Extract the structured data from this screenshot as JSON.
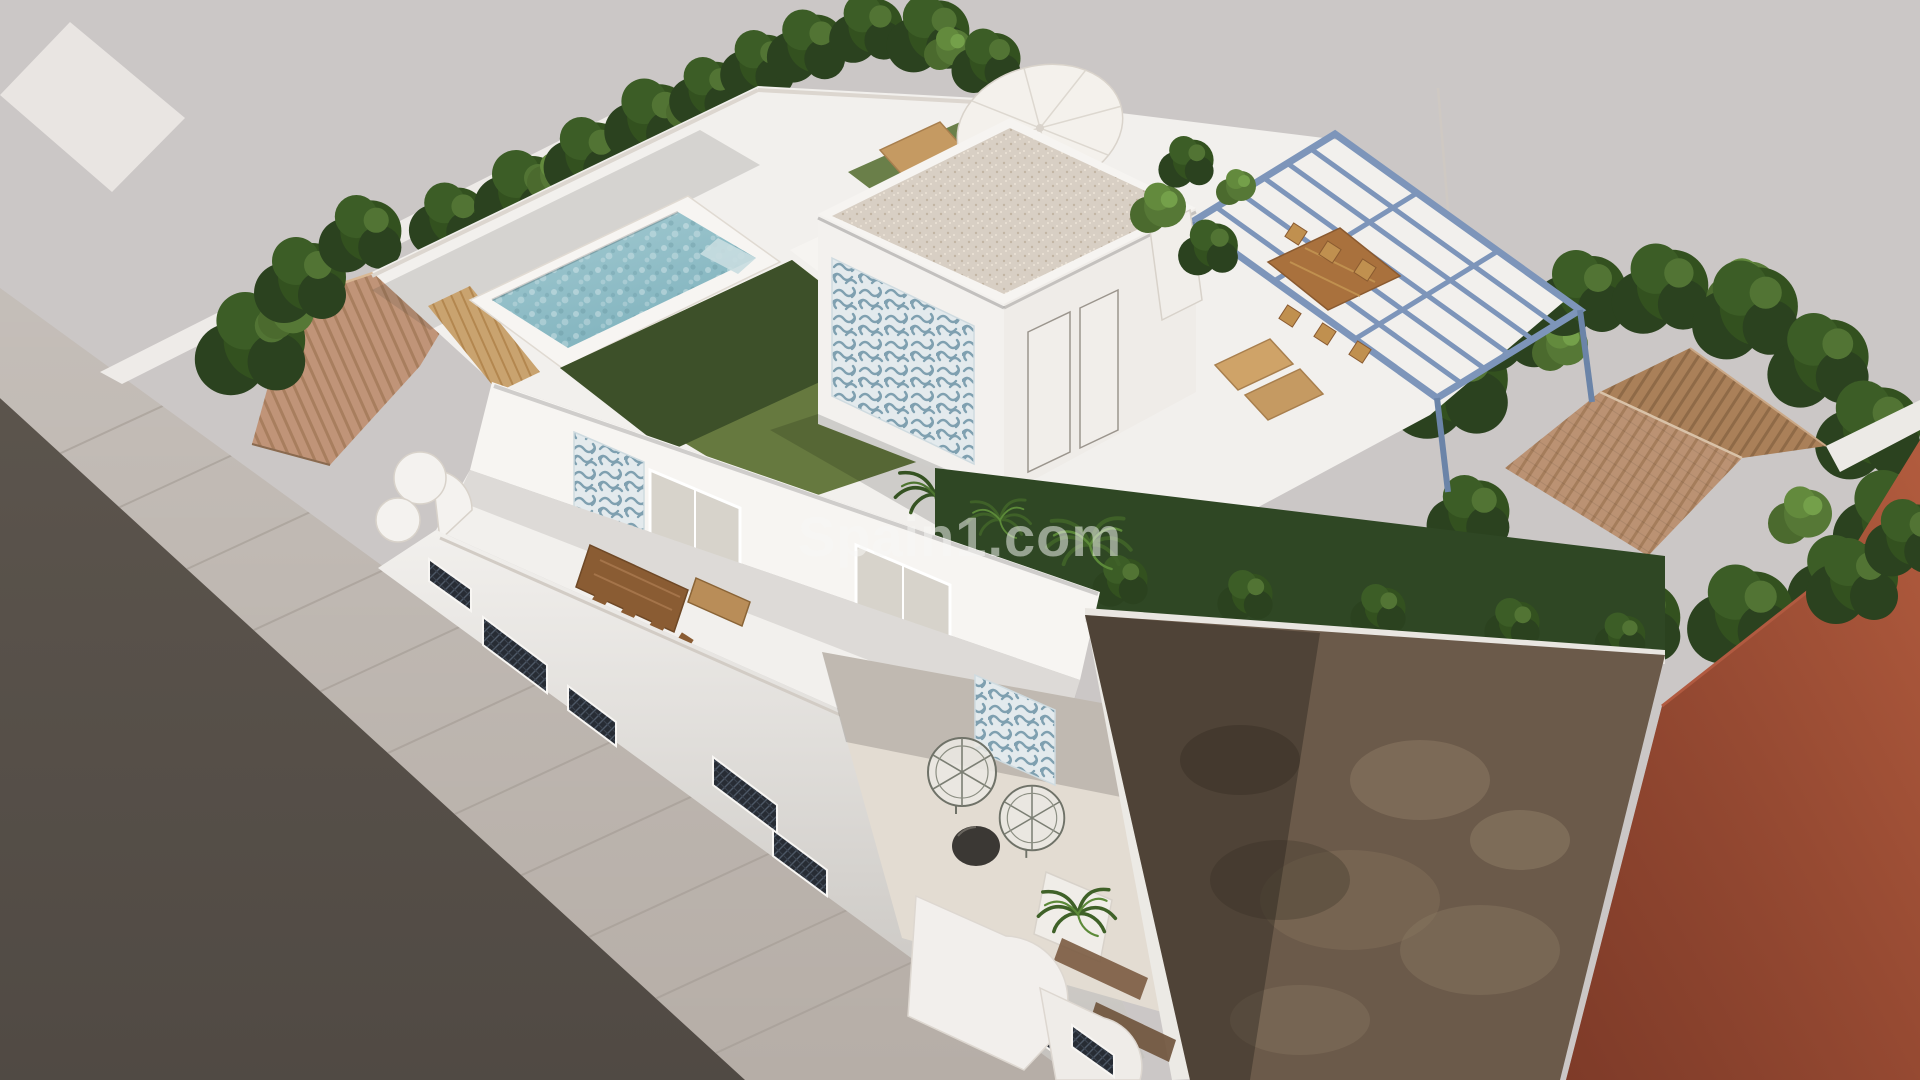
{
  "scene": {
    "description": "Aerial 3D architectural rendering of a modern white three-storey villa on a corner plot: rooftop terrace with rectangular pool, lawn, sun loungers with white parasol, roof access structure with blue-and-white patterned tile mural, steel-blue pergola over an outdoor dining area, middle terrace with wooden dining table, street facade with dark lattice window screens, curved balconies, lower patio with two wire egg chairs, neighbouring house with terracotta hipped roof among trees, bare earth side lot and a rust-coloured adjacent building; asphalt road and paved sidewalk along the left."
  },
  "watermark": {
    "text": "Spain1.com",
    "color": "rgba(248,247,245,0.52)"
  },
  "palette": {
    "background": "#cbc7c6",
    "road": "#57504a",
    "sidewalk": "#b6aea7",
    "villa_white": "#f2f0ed",
    "wall_bright": "#f7f5f2",
    "pool_water": "#8fbac4",
    "pool_water_light": "#aed2d8",
    "lawn": "#66793f",
    "lawn_shadow": "#3d5029",
    "turf": "#6a7f49",
    "hedge": "#2f4724",
    "tree_dark": "#2c4420",
    "tree_light": "#5d7c3b",
    "terracotta_roof": "#bb9273",
    "terracotta_roof_dark": "#a47e5d",
    "gravel_roof": "#d8cfc5",
    "pergola_blue": "#7d95ba",
    "mural_blue": "#7fa0b0",
    "wood": "#c59a62",
    "wood_dark": "#a9713d",
    "terrace_beige": "#e3dcd2",
    "lattice_dark": "#2a2f38",
    "dirt": "#6b5a4a",
    "dirt_light": "#8d7a64",
    "rust_wall": "#9c4a34"
  }
}
